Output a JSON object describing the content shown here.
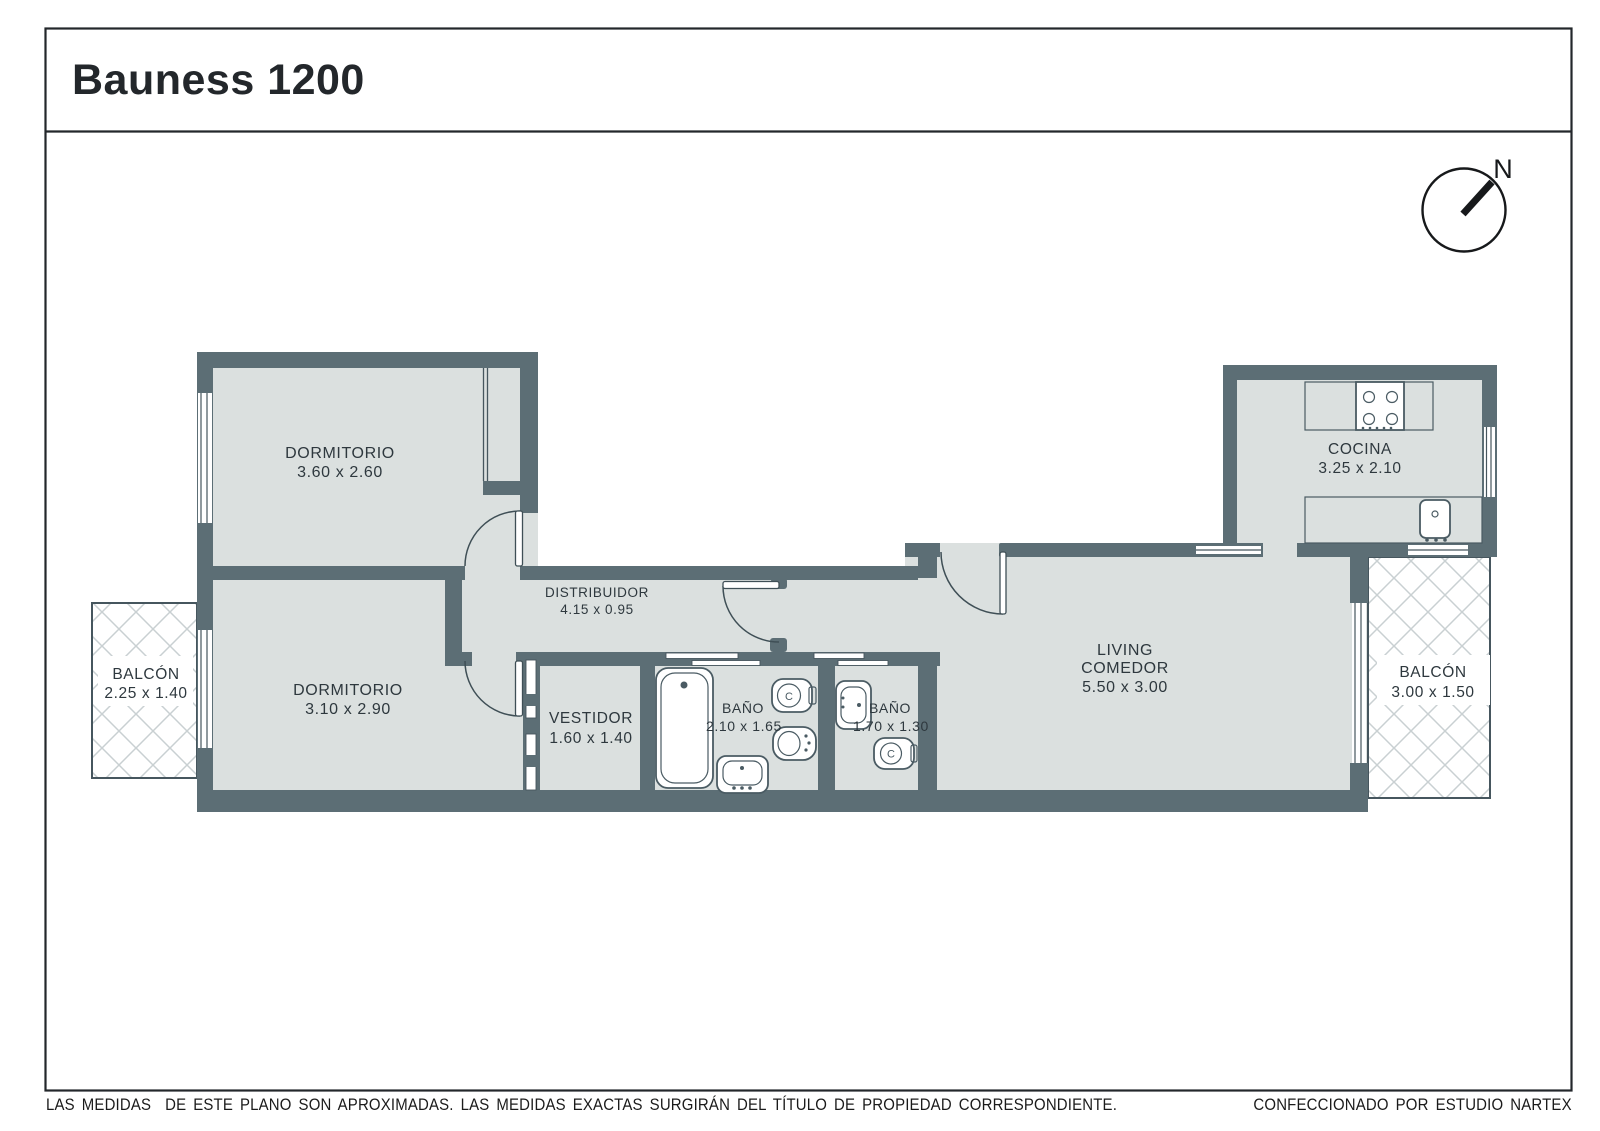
{
  "title": "Bauness 1200",
  "compass": {
    "north": "N"
  },
  "rooms": {
    "dormitorio1": {
      "label": "DORMITORIO",
      "dims": "3.60 x 2.60"
    },
    "dormitorio2": {
      "label": "DORMITORIO",
      "dims": "3.10 x 2.90"
    },
    "distribuidor": {
      "label": "DISTRIBUIDOR",
      "dims": "4.15 x 0.95"
    },
    "vestidor": {
      "label": "VESTIDOR",
      "dims": "1.60 x 1.40"
    },
    "bano1": {
      "label": "BAÑO",
      "dims": "2.10 x 1.65"
    },
    "bano2": {
      "label": "BAÑO",
      "dims": "1.70 x 1.30"
    },
    "living": {
      "label1": "LIVING",
      "label2": "COMEDOR",
      "dims": "5.50 x 3.00"
    },
    "cocina": {
      "label": "COCINA",
      "dims": "3.25 x 2.10"
    },
    "balcon_izq": {
      "label": "BALCÓN",
      "dims": "2.25 x 1.40"
    },
    "balcon_der": {
      "label": "BALCÓN",
      "dims": "3.00 x 1.50"
    }
  },
  "fixtures": {
    "toilet_label": "C"
  },
  "footer": {
    "disclaimer": "LAS MEDIDAS  DE ESTE PLANO SON APROXIMADAS. LAS MEDIDAS EXACTAS SURGIRÁN DEL TÍTULO DE PROPIEDAD CORRESPONDIENTE.",
    "credit": "CONFECCIONADO POR ESTUDIO NARTEX"
  },
  "colors": {
    "wall": "#5c6e75",
    "room_fill": "#dbe0df",
    "lattice_line": "#c9d0d2",
    "outline": "#46565e",
    "text": "#2e383e"
  }
}
